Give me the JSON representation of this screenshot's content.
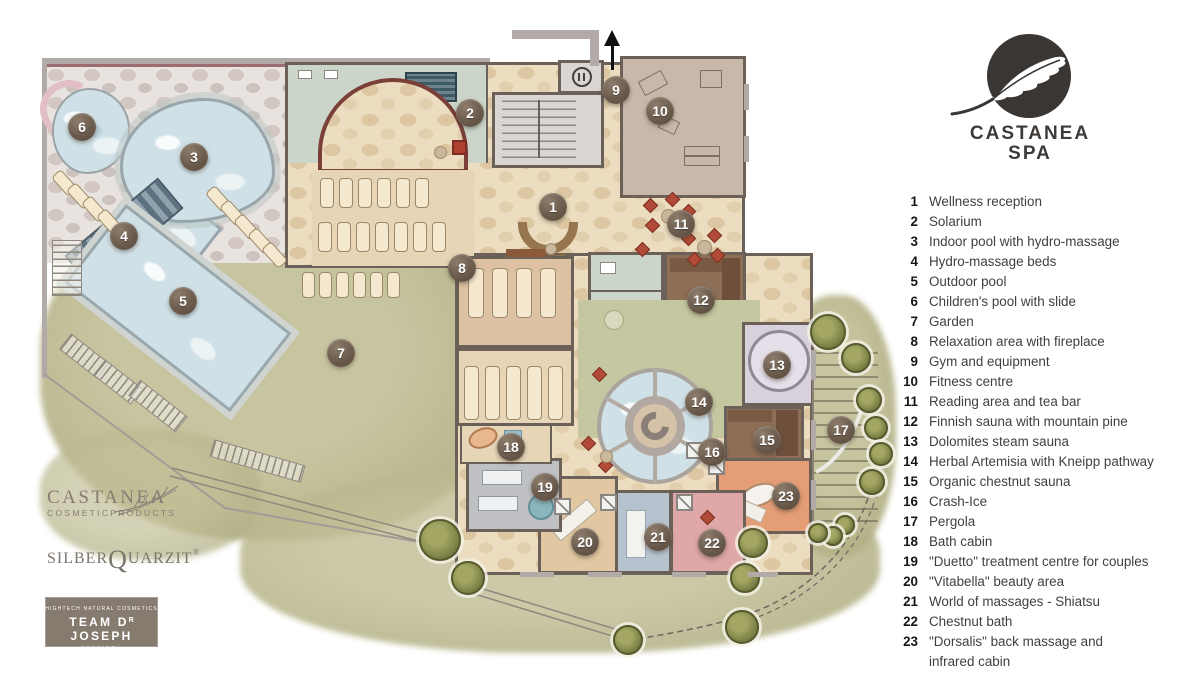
{
  "brand": {
    "line1": "CASTANEA",
    "line2": "SPA"
  },
  "legend": {
    "items": [
      {
        "n": "1",
        "label": "Wellness reception"
      },
      {
        "n": "2",
        "label": "Solarium"
      },
      {
        "n": "3",
        "label": "Indoor pool with hydro-massage"
      },
      {
        "n": "4",
        "label": "Hydro-massage beds"
      },
      {
        "n": "5",
        "label": "Outdoor pool"
      },
      {
        "n": "6",
        "label": "Children's pool with slide"
      },
      {
        "n": "7",
        "label": "Garden"
      },
      {
        "n": "8",
        "label": "Relaxation area with fireplace"
      },
      {
        "n": "9",
        "label": "Gym and equipment"
      },
      {
        "n": "10",
        "label": "Fitness centre"
      },
      {
        "n": "11",
        "label": "Reading area and tea bar"
      },
      {
        "n": "12",
        "label": "Finnish sauna with mountain pine"
      },
      {
        "n": "13",
        "label": "Dolomites steam sauna"
      },
      {
        "n": "14",
        "label": "Herbal Artemisia with Kneipp pathway"
      },
      {
        "n": "15",
        "label": "Organic chestnut sauna"
      },
      {
        "n": "16",
        "label": "Crash-Ice"
      },
      {
        "n": "17",
        "label": "Pergola"
      },
      {
        "n": "18",
        "label": "Bath cabin"
      },
      {
        "n": "19",
        "label": "\"Duetto\" treatment centre for couples"
      },
      {
        "n": "20",
        "label": "\"Vitabella\" beauty area"
      },
      {
        "n": "21",
        "label": "World of massages - Shiatsu"
      },
      {
        "n": "22",
        "label": "Chestnut bath"
      },
      {
        "n": "23",
        "label": "\"Dorsalis\" back massage and",
        "label2": "infrared cabin"
      }
    ]
  },
  "markers": [
    {
      "n": "1",
      "x": 553,
      "y": 207
    },
    {
      "n": "2",
      "x": 470,
      "y": 113
    },
    {
      "n": "3",
      "x": 194,
      "y": 157
    },
    {
      "n": "4",
      "x": 124,
      "y": 236
    },
    {
      "n": "5",
      "x": 183,
      "y": 301
    },
    {
      "n": "6",
      "x": 82,
      "y": 127
    },
    {
      "n": "7",
      "x": 341,
      "y": 353
    },
    {
      "n": "8",
      "x": 462,
      "y": 268
    },
    {
      "n": "9",
      "x": 616,
      "y": 90
    },
    {
      "n": "10",
      "x": 660,
      "y": 111
    },
    {
      "n": "11",
      "x": 681,
      "y": 224
    },
    {
      "n": "12",
      "x": 701,
      "y": 300
    },
    {
      "n": "13",
      "x": 777,
      "y": 365
    },
    {
      "n": "14",
      "x": 699,
      "y": 402
    },
    {
      "n": "15",
      "x": 767,
      "y": 440
    },
    {
      "n": "16",
      "x": 712,
      "y": 452
    },
    {
      "n": "17",
      "x": 841,
      "y": 430
    },
    {
      "n": "18",
      "x": 511,
      "y": 447
    },
    {
      "n": "19",
      "x": 545,
      "y": 487
    },
    {
      "n": "20",
      "x": 585,
      "y": 542
    },
    {
      "n": "21",
      "x": 658,
      "y": 537
    },
    {
      "n": "22",
      "x": 712,
      "y": 543
    },
    {
      "n": "23",
      "x": 786,
      "y": 496
    }
  ],
  "footer_logos": {
    "castanea": {
      "title": "CASTANEA",
      "subtitle": "COSMETICPRODUCTS"
    },
    "silberquarzit": {
      "part1": "SILBER",
      "q": "Q",
      "part2": "UARZIT",
      "reg": "®"
    },
    "team_dr_joseph": {
      "line1": "HIGHTECH NATURAL COSMETICS",
      "main_prefix": "TEAM D",
      "sup": "R",
      "main_suffix": " JOSEPH",
      "line3": "SÜDTIROL"
    }
  },
  "colors": {
    "logo_dark": "#3a3633",
    "marker": "#6b5b4d",
    "garden_green": "#b5b286",
    "pool_blue": "#cfe1e7",
    "building_tan": "#ecddc0",
    "terrace_stone": "#e9e3df",
    "sage_floor": "#c5c7a0",
    "sauna_brown": "#8d6e56",
    "steam_lavender": "#d7d1db",
    "chestnut_bath_pink": "#dfa7a7",
    "massage_blue": "#b6c2cd",
    "duetto_gray": "#bfc0c4",
    "dorsalis_salmon": "#e59d76",
    "beauty_tan": "#e1c8a2",
    "changing_green": "#cbd5c9",
    "fitness_taupe": "#c8b8aa",
    "legend_text": "#3f3f3f"
  }
}
